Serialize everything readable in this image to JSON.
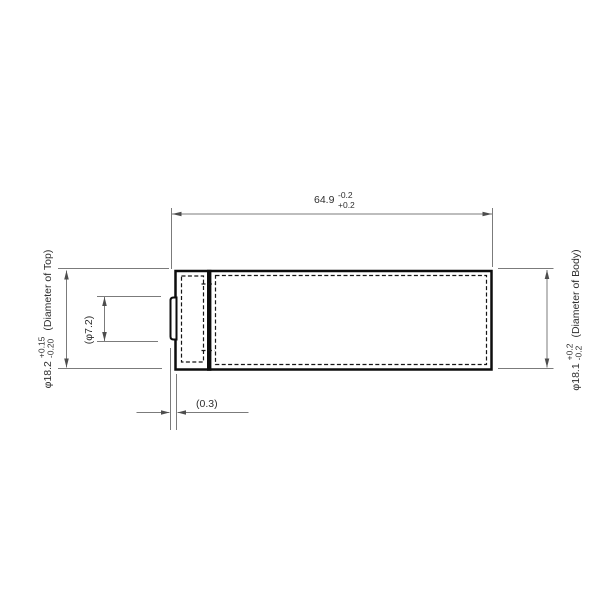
{
  "drawing": {
    "subject": "battery-cell-side-view-dimension-drawing",
    "dims": {
      "length": {
        "value": "64.9",
        "tol_upper": "-0.2",
        "tol_lower": "+0.2"
      },
      "top_diameter": {
        "value": "φ18.2",
        "tol_upper": "+0.15",
        "tol_lower": "-0.20",
        "desc": "(Diameter of Top)"
      },
      "button_diameter": {
        "value": "(φ7.2)"
      },
      "body_diameter": {
        "value": "φ18.1",
        "tol_upper": "+0.2",
        "tol_lower": "-0.2",
        "desc": "(Diameter of Body)"
      },
      "button_gap": {
        "value": "(0.3)"
      }
    },
    "colors": {
      "background": "#ffffff",
      "outline": "#0d0d0d",
      "dimension_lines": "#7b7b7b",
      "text": "#2e2e2e"
    }
  }
}
